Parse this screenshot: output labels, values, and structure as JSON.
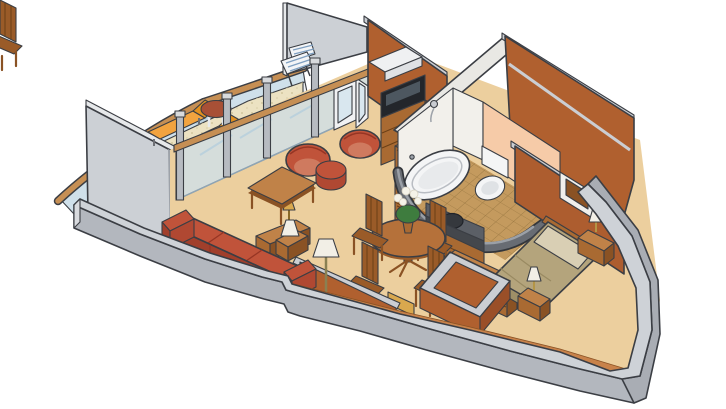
{
  "meta": {
    "title": "Isometric cutaway floor plan of a cruise ship suite",
    "type": "floorplan-illustration",
    "background": "#ffffff"
  },
  "rooms": {
    "balcony": {
      "label": "Veranda",
      "furniture": [
        "lounge-chair",
        "lounge-chair",
        "round-table",
        "folding-deck-chair"
      ]
    },
    "living_room": {
      "label": "Living room",
      "furniture": [
        "sofa",
        "coffee-table",
        "barrel-chair",
        "barrel-chair",
        "ottoman",
        "side-table",
        "table-lamp",
        "floor-lamp",
        "sideboard",
        "tv-cabinet",
        "shelf-unit"
      ]
    },
    "dining_area": {
      "label": "Dining area",
      "furniture": [
        "round-dining-table",
        "dining-chair",
        "dining-chair",
        "dining-chair",
        "dining-chair",
        "flower-vase"
      ]
    },
    "bathroom": {
      "label": "Bathroom",
      "furniture": [
        "bathtub",
        "toilet",
        "vanity-sink",
        "shower-head"
      ]
    },
    "bedroom": {
      "label": "Bedroom",
      "furniture": [
        "double-bed",
        "nightstand",
        "nightstand",
        "bedside-lamp",
        "bedside-lamp",
        "dresser",
        "wall-picture"
      ]
    },
    "entry": {
      "label": "Entry vestibule",
      "furniture": [
        "low-partition-walls",
        "luggage-bench"
      ]
    }
  },
  "palette": {
    "background": "#ffffff",
    "carpet": "#eccf9e",
    "balcony_floor": "#ece2c2",
    "tile": "#c49a5e",
    "glass": "#cfe0ea",
    "rail_wood": "#c68f54",
    "wood_light": "#c08248",
    "wood_table": "#b5713a",
    "terracotta": "#b0602f",
    "terracotta_dark": "#ad5d2f",
    "peach_wall": "#f6cba8",
    "white_wall": "#f2f0eb",
    "wall_gray_top": "#ced2d7",
    "wall_gray_face": "#b3b7be",
    "wall_gray_light": "#ccd0d5",
    "wall_dark_cut": "#686c73",
    "upholstery": "#c0533a",
    "lounger_orange": "#f2a33f",
    "bedspread": "#b4a47c",
    "pillow": "#d9cfb4",
    "lamp_shade": "#f2efe6",
    "counter_dark": "#5b5f66",
    "plant_green": "#3e7c3e",
    "flower_white": "#f5f2e8"
  }
}
